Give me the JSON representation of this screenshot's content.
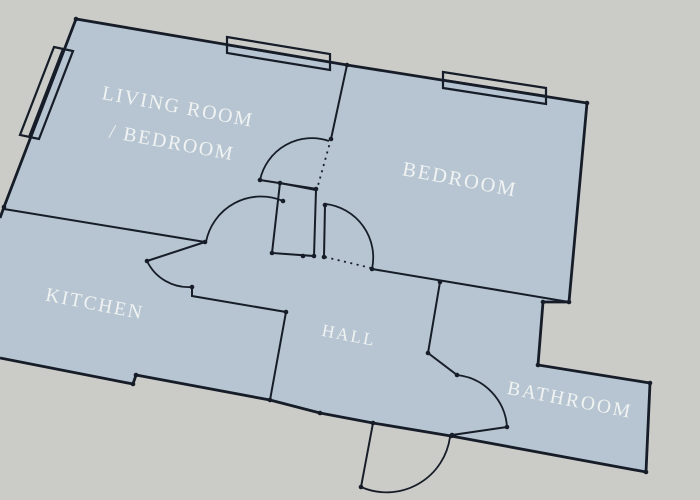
{
  "scene": {
    "background": "#cbccc7",
    "floor_fill": "#b6c5d1",
    "line_color": "#161d28",
    "label_color": "#f4f6f4"
  },
  "rooms": [
    {
      "id": "living-room",
      "label_line1": "LIVING ROOM",
      "label_line2": "/ BEDROOM"
    },
    {
      "id": "bedroom",
      "label": "BEDROOM"
    },
    {
      "id": "kitchen",
      "label": "KITCHEN"
    },
    {
      "id": "hall",
      "label": "HALL"
    },
    {
      "id": "bathroom",
      "label": "BATHROOM"
    }
  ]
}
